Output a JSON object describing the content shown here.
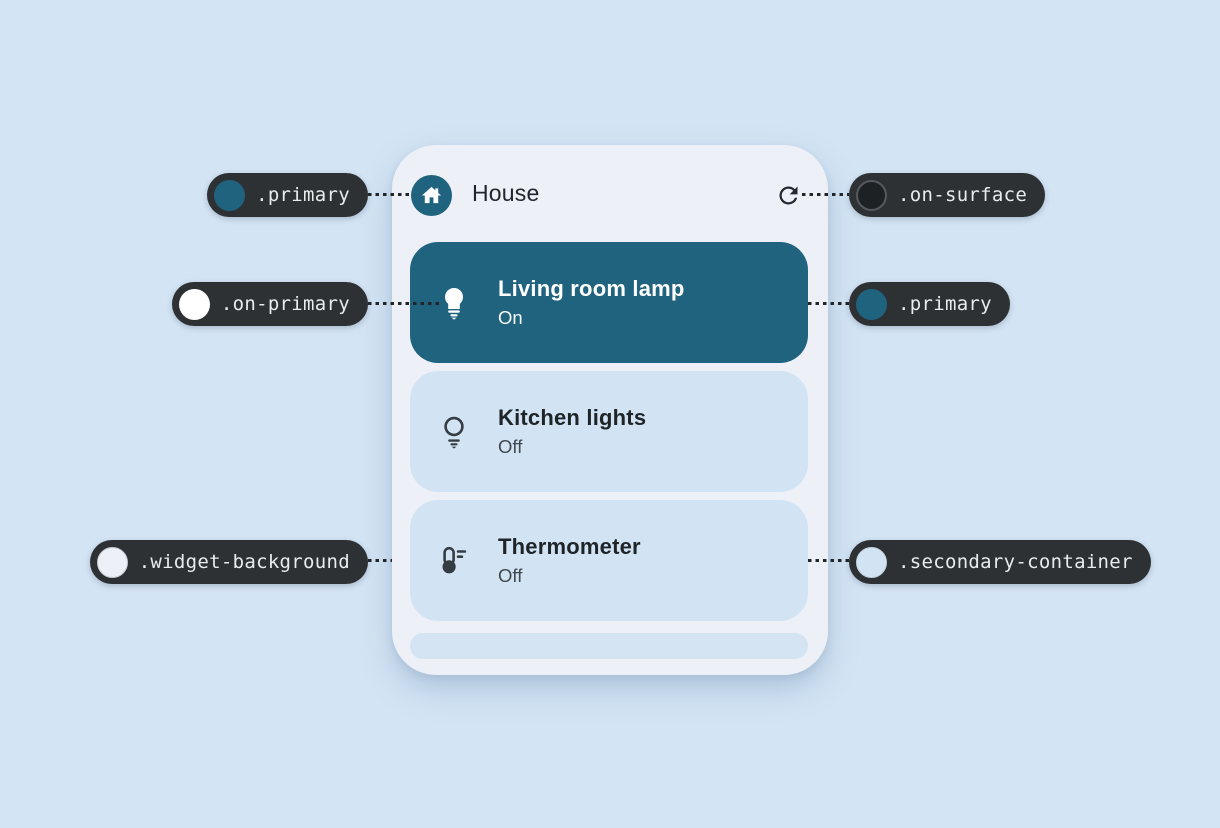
{
  "colors": {
    "page_background": "#d3e4f4",
    "widget_background": "#edf0f6",
    "primary": "#20637f",
    "on_primary": "#ffffff",
    "on_surface": "#1d2124",
    "secondary_container": "#d2e4f4",
    "callout_background": "#2d3134"
  },
  "widget": {
    "title": "House",
    "rows": [
      {
        "name": "Living room lamp",
        "status": "On"
      },
      {
        "name": "Kitchen lights",
        "status": "Off"
      },
      {
        "name": "Thermometer",
        "status": "Off"
      }
    ]
  },
  "callouts": {
    "top_left": {
      "label": ".primary",
      "dot": "#20637f"
    },
    "top_right": {
      "label": ".on-surface",
      "dot": "#1d2124"
    },
    "mid_left": {
      "label": ".on-primary",
      "dot": "#ffffff"
    },
    "mid_right": {
      "label": ".primary",
      "dot": "#20637f"
    },
    "bottom_left": {
      "label": ".widget-background",
      "dot": "#edf0f6"
    },
    "bottom_right": {
      "label": ".secondary-container",
      "dot": "#d2e4f4"
    }
  }
}
